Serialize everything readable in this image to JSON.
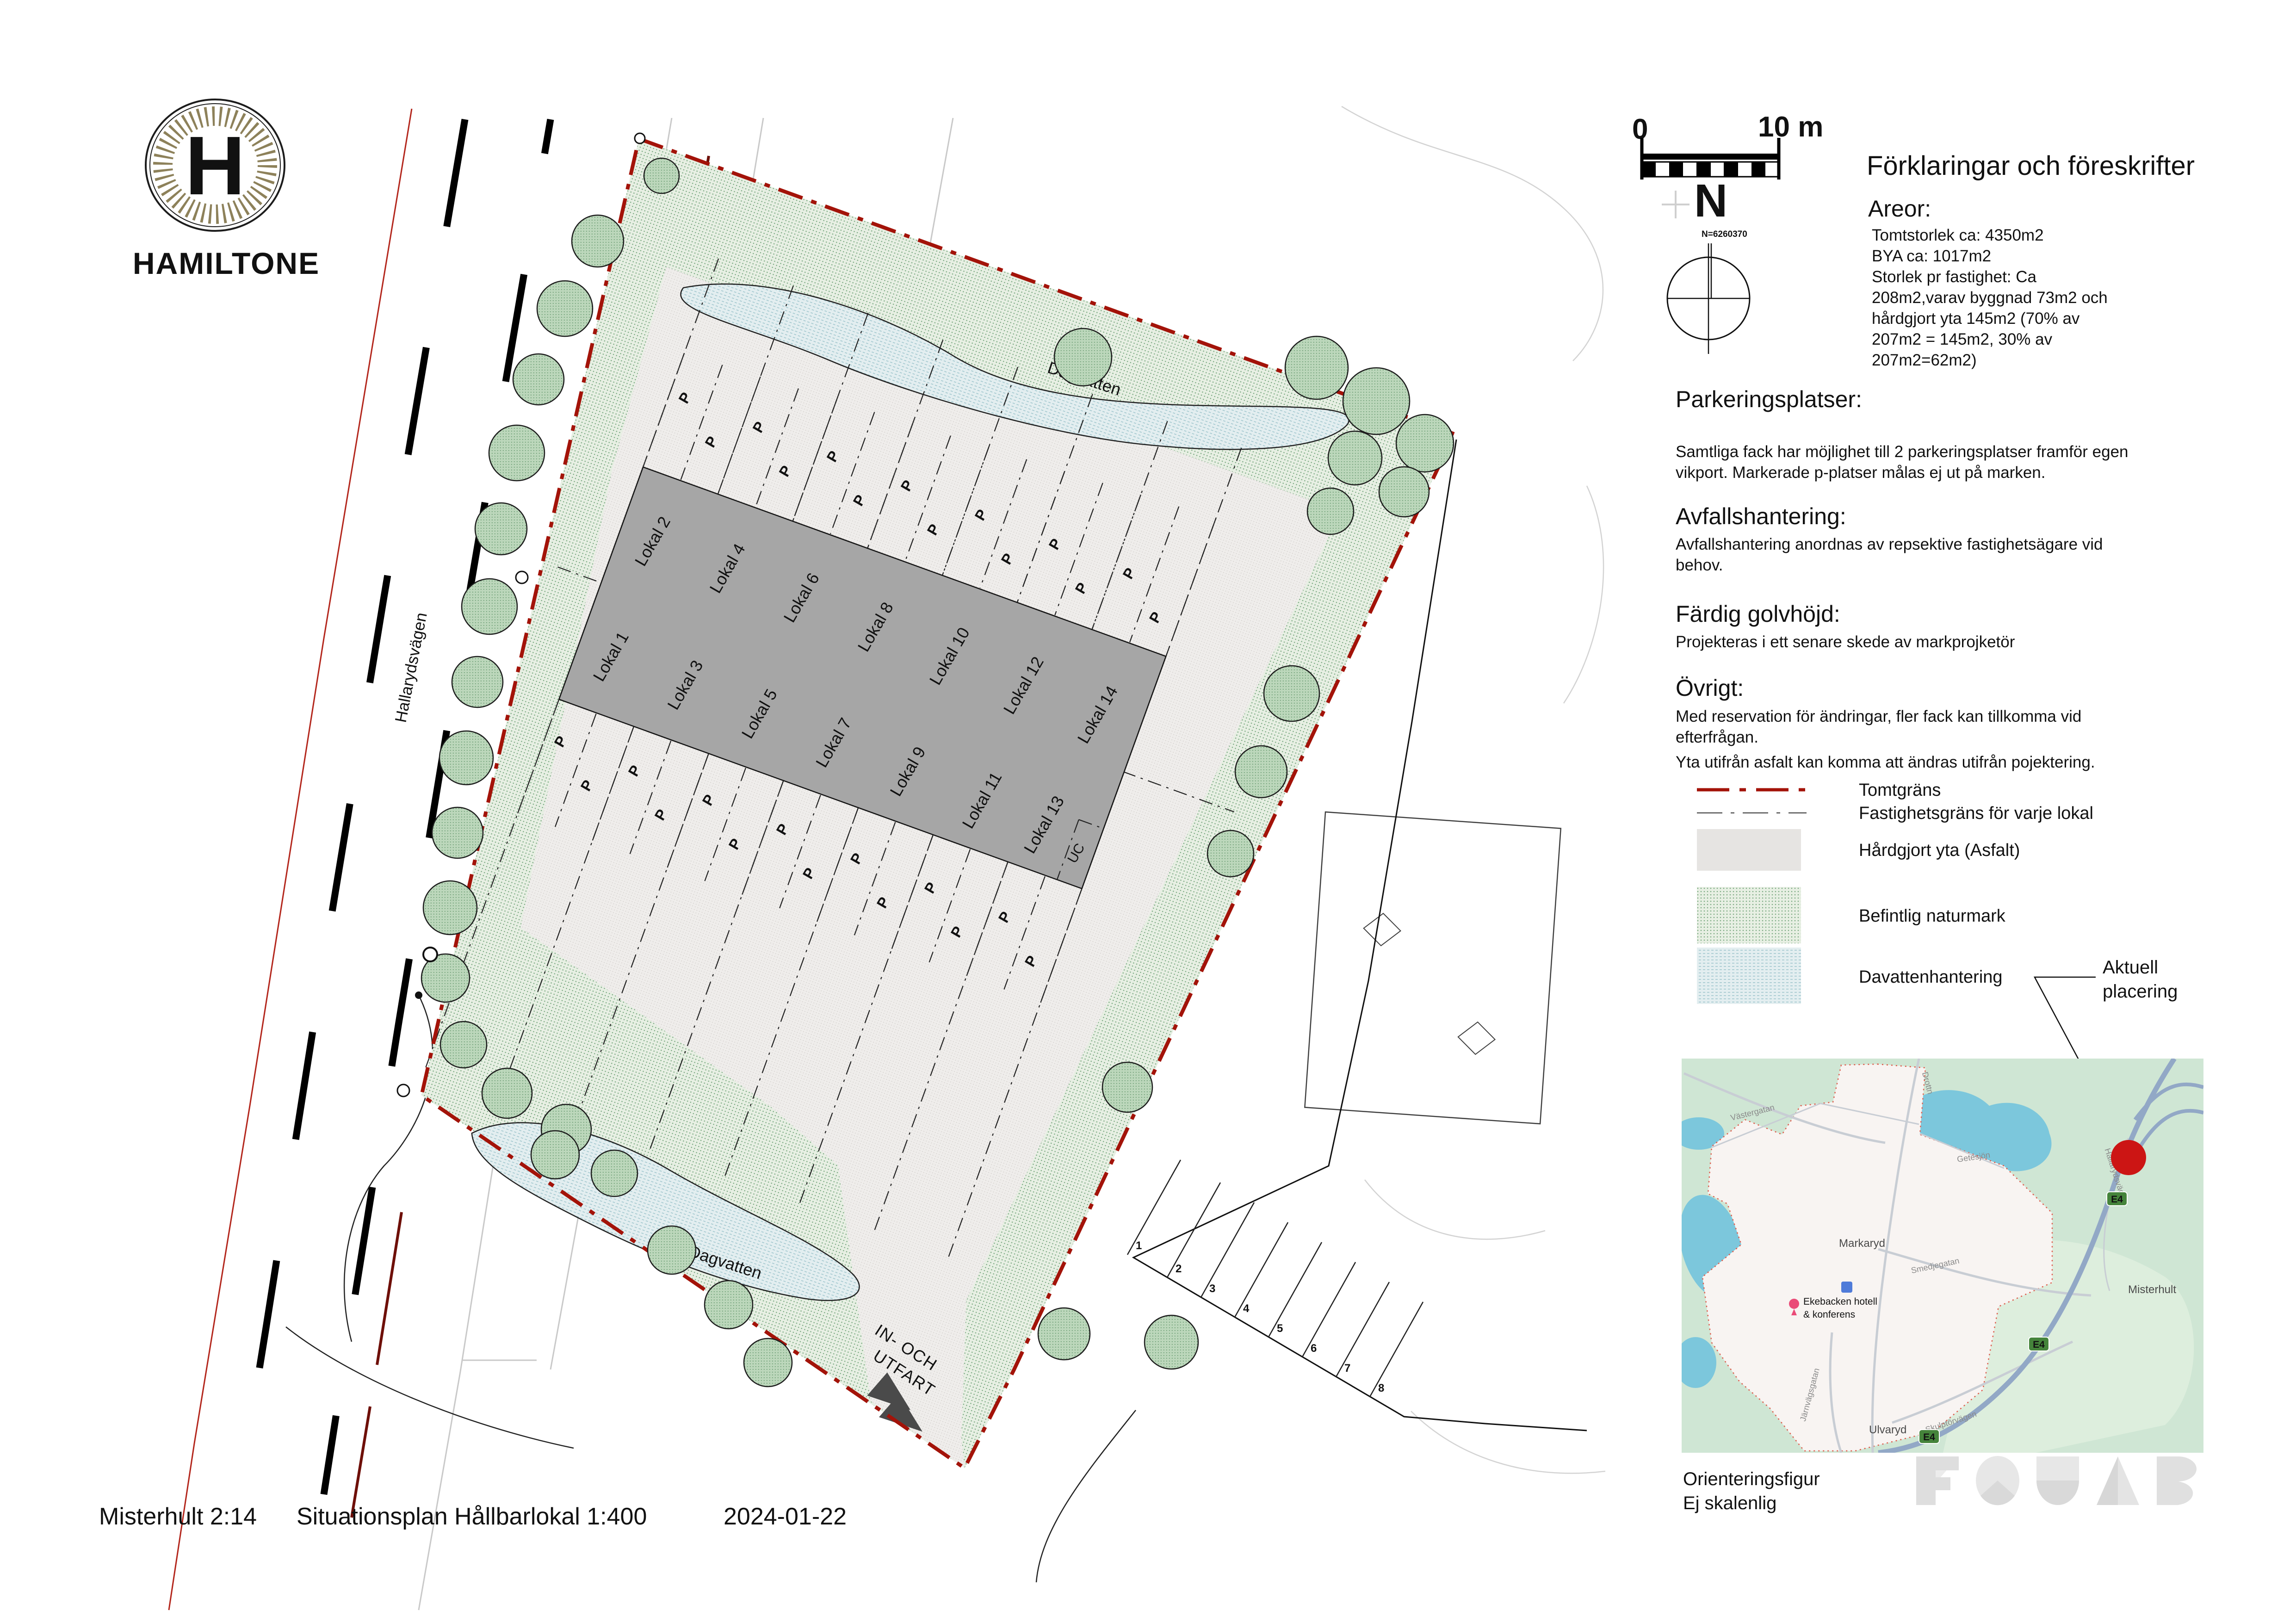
{
  "branding": {
    "monogram": "H",
    "wordmark": "HAMILTONE"
  },
  "scale_bar": {
    "left_label": "0",
    "right_label": "10 m"
  },
  "north": {
    "letter": "N",
    "coordinate": "N=6260370"
  },
  "notes_panel": {
    "title": "Förklaringar och föreskrifter",
    "areor_heading": "Areor:",
    "areor_lines": [
      "Tomtstorlek ca:  4350m2",
      "BYA ca: 1017m2",
      "Storlek pr fastighet: Ca",
      "208m2,varav byggnad 73m2 och",
      "hårdgjort yta 145m2 (70% av",
      "207m2 = 145m2, 30% av",
      "207m2=62m2)"
    ],
    "parkering_heading": "Parkeringsplatser:",
    "parkering_lines": [
      "Samtliga fack har möjlighet till 2 parkeringsplatser framför egen",
      "vikport. Markerade p-platser målas ej ut på marken."
    ],
    "avfall_heading": "Avfallshantering:",
    "avfall_lines": [
      "Avfallshantering anordnas av repsektive fastighetsägare vid",
      "behov."
    ],
    "golvhojd_heading": "Färdig golvhöjd:",
    "golvhojd_lines": [
      "Projekteras i ett senare skede av markprojketör"
    ],
    "ovrigt_heading": "Övrigt:",
    "ovrigt_lines": [
      "Med reservation för ändringar, fler fack kan tillkomma vid",
      "efterfrågan.",
      "Yta utifrån asfalt kan komma att ändras utifrån pojektering."
    ]
  },
  "legend": {
    "tomtgrans": "Tomtgräns",
    "fastighetsgrans": "Fastighetsgräns för varje lokal",
    "hardgjort": "Hårdgjort yta (Asfalt)",
    "naturmark": "Befintlig naturmark",
    "dagvatten": "Davattenhantering",
    "colors": {
      "tomtgrans": "#a31309",
      "fastighetsgrans": "#555555",
      "hardgjort": "#e6e4e2",
      "naturmark": "#dce9d8",
      "dagvatten": "#e3eef0"
    }
  },
  "plan": {
    "road_label": "Hallarydsvägen",
    "dagvatten_label": "Dagvatten",
    "entrance_line1": "IN- OCH",
    "entrance_line2": "UTFART",
    "uc_label": "UC",
    "parking_letter": "P",
    "lokaler_top": [
      "Lokal 2",
      "Lokal 4",
      "Lokal 6",
      "Lokal 8",
      "Lokal 10",
      "Lokal 12",
      "Lokal 14"
    ],
    "lokaler_bottom": [
      "Lokal 1",
      "Lokal 3",
      "Lokal 5",
      "Lokal 7",
      "Lokal 9",
      "Lokal 11",
      "Lokal 13"
    ],
    "fence_numbers": [
      "1",
      "2",
      "3",
      "4",
      "5",
      "6",
      "7",
      "8"
    ]
  },
  "callout": {
    "line1": "Aktuell",
    "line2": "placering"
  },
  "map": {
    "caption_line1": "Orienteringsfigur",
    "caption_line2": "Ej skalenlig",
    "labels": {
      "town": "Markaryd",
      "district_south": "Ulvaryd",
      "district_east": "Misterhult",
      "lake": "Getesjön",
      "street_west": "Västergatan",
      "street_north": "Drottn",
      "street_mid": "Smedjegatan",
      "street_rail": "Järnvägsgatan",
      "street_south": "Skulptörvägen",
      "street_site": "Hallarydsvägen",
      "poi_line1": "Ekebacken hotell",
      "poi_line2": "& konferens",
      "road_badge": "E4"
    }
  },
  "titleblock": {
    "property": "Misterhult 2:14",
    "drawing": "Situationsplan Hållbarlokal 1:400",
    "date": "2024-01-22"
  },
  "fojab_wordmark": "FOJAB"
}
